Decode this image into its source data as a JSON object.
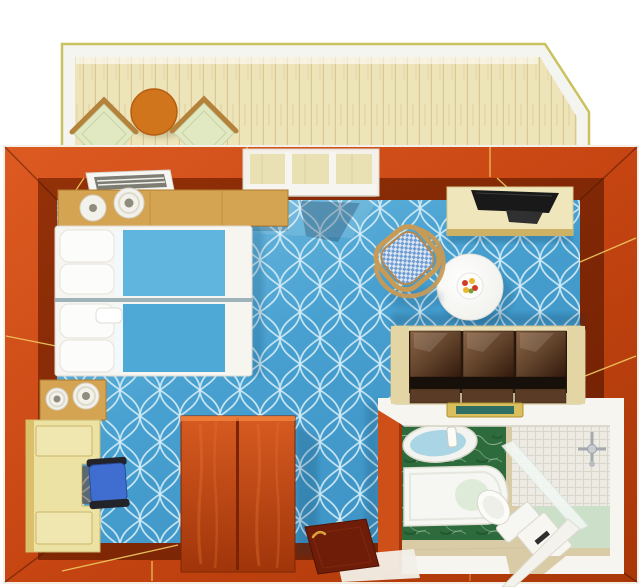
{
  "meta": {
    "kind": "3d-rendered-floor-plan",
    "subject": "cabin-top-view-with-balcony-bedroom-bathroom"
  },
  "colors": {
    "background": "#ffffff",
    "wall_outer_light": "#dd5b22",
    "wall_outer_dark": "#a93708",
    "wall_inner_face": "#7e2605",
    "wall_seam_gold": "#ecc45e",
    "balcony_floor": "#eee4ba",
    "balcony_plank_line": "#d8c992",
    "balcony_rail": "#f4f4f0",
    "balcony_trim": "#c9c25e",
    "balcony_table": "#d0751b",
    "balcony_chair_cushion": "#e0e9c2",
    "balcony_chair_frame": "#b5823c",
    "carpet_light": "#7cc3e4",
    "carpet_base": "#47a0d0",
    "carpet_deep": "#3b90c2",
    "carpet_lattice": "#d2ecf7",
    "bed_linen": "#f6f5f0",
    "bed_blanket_1": "#5fb5de",
    "bed_blanket_2": "#4ea9d7",
    "pillow_white": "#fcfcfa",
    "console_wood": "#d5a452",
    "lamp_white": "#f2f1ea",
    "vanity_cream": "#ece2a4",
    "desk_chair_blue": "#3f6ed0",
    "wardrobe_light": "#d75b21",
    "wardrobe_dark": "#a0350a",
    "entry_door_maroon": "#6f1d08",
    "door_handle_gold": "#d9a33c",
    "vent_white": "#f6f6f3",
    "window_frame": "#f3f1ea",
    "mesh_chair_seat": "#6f9cd2",
    "mesh_chair_frame": "#c79a56",
    "tv_desk_cream": "#efe6bc",
    "laptop_black": "#191919",
    "sofa_frame": "#e9dfb6",
    "sofa_cushion_light": "#8a6546",
    "sofa_cushion_dark": "#32190c",
    "sofa_seat_shadow": "#17100a",
    "table_white": "#fafaf7",
    "fruit_red": "#d43a28",
    "fruit_yellow": "#eeb32e",
    "fruit_green": "#7aa12f",
    "tray_gold": "#d9bf5e",
    "tray_teal": "#2e6e63",
    "bath_wall_white": "#f6f5ef",
    "bath_floor_beige": "#d9cba6",
    "marble_green": "#2d6b3d",
    "sink_basin_blue": "#a9d5e5",
    "tub_white": "#f6f6f2",
    "tile_face": "#eceae2",
    "shower_floor_green": "#cbdfc9",
    "fixture_chrome": "#a4a9ae",
    "bath_door_white": "#f4f2ec"
  },
  "inventory": {
    "balcony": [
      "wood-plank-floor",
      "railing",
      "round-table",
      "lounge-chair-left",
      "lounge-chair-right"
    ],
    "bedroom": [
      "twin-bed-upper",
      "twin-bed-lower",
      "headboard-console",
      "table-lamp",
      "table-lamp",
      "air-vent",
      "balcony-window",
      "nightstand",
      "vanity-desk",
      "desk-chair",
      "wardrobe",
      "entry-door",
      "wicker-chair",
      "tv-desk",
      "tv",
      "sofa",
      "round-dining-table",
      "fruit-plate",
      "welcome-tray"
    ],
    "bathroom": [
      "washbasin",
      "bathtub",
      "toilet",
      "storage-cabinet",
      "shower",
      "glass-partition",
      "shower-fixture",
      "bathroom-door"
    ]
  },
  "counts": {
    "beds": 2,
    "lamps": 4,
    "sofa_cushions": 3,
    "balcony_chairs": 2
  }
}
